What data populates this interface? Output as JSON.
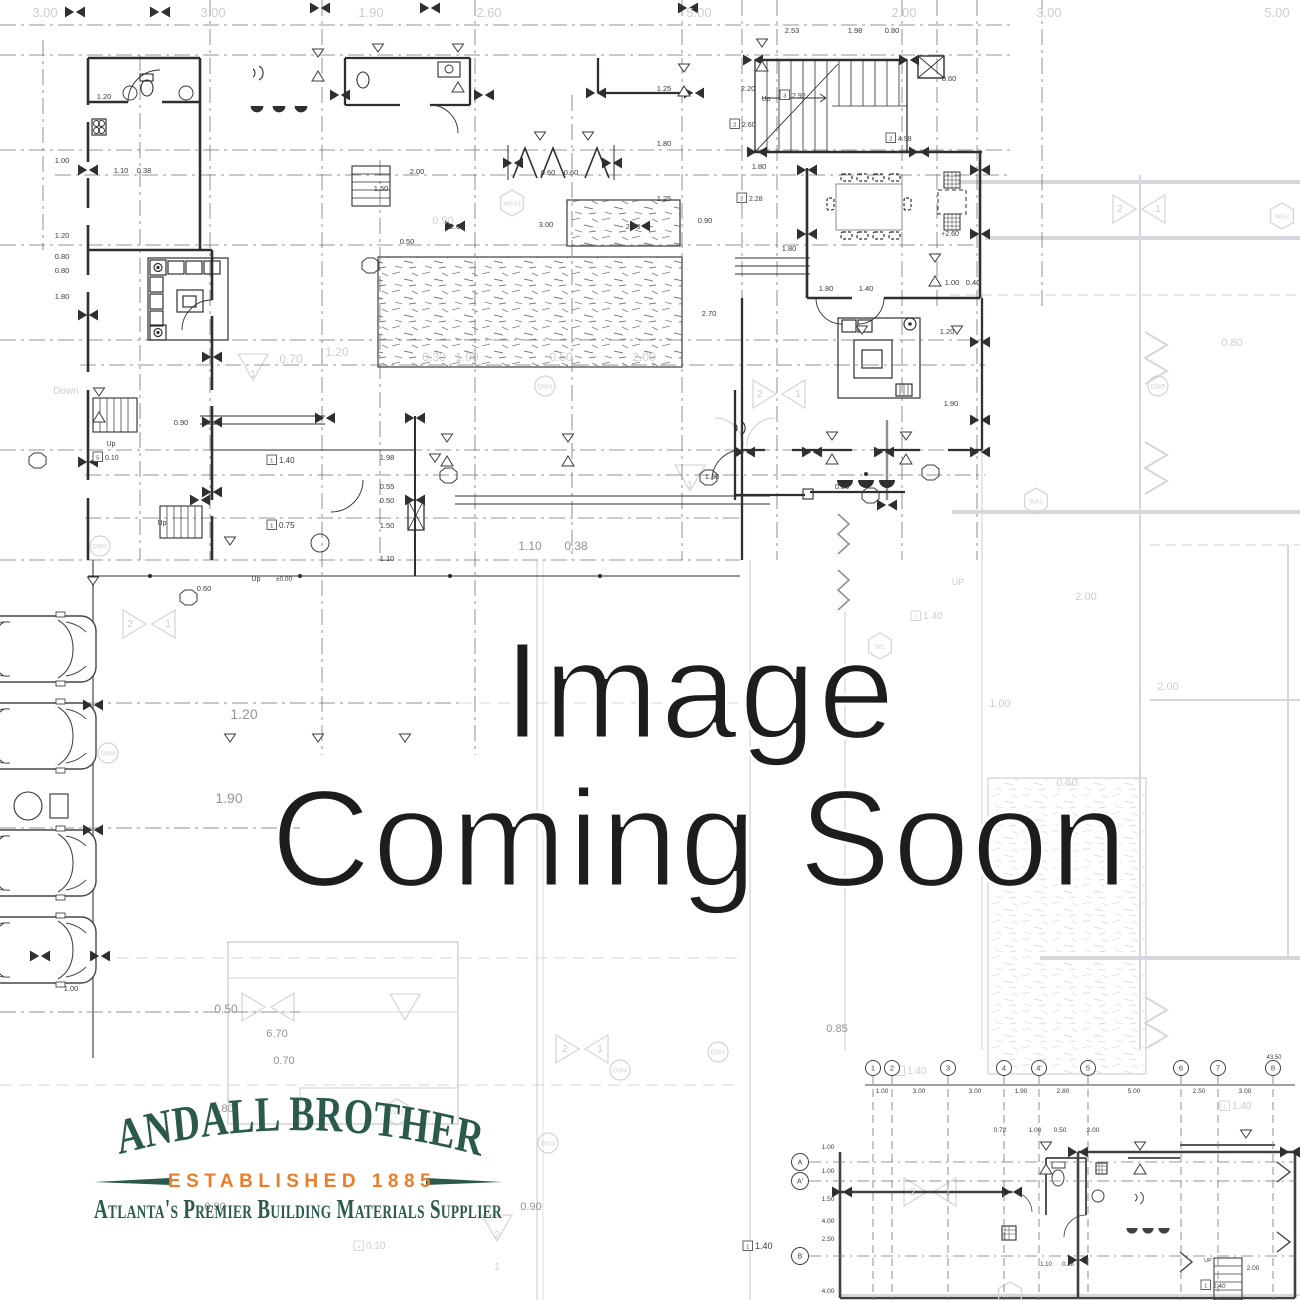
{
  "page": {
    "background": "#ffffff"
  },
  "placeholder": {
    "line1": "Image",
    "line2": "Coming Soon",
    "text_color": "#1d1d1f"
  },
  "logo": {
    "brand": "RANDALL BROTHERS",
    "established": "ESTABLISHED 1885",
    "tagline": "Atlanta's Premier Building Materials Supplier",
    "green": "#2b5a4d",
    "orange": "#ee7b27"
  },
  "blueprint": {
    "dimension_labels": [
      {
        "t": "3.00",
        "x": 45,
        "y": 17,
        "c": "f",
        "s": 13
      },
      {
        "t": "3.00",
        "x": 213,
        "y": 17,
        "c": "f",
        "s": 13
      },
      {
        "t": "1.90",
        "x": 371,
        "y": 17,
        "c": "f",
        "s": 13
      },
      {
        "t": "2.60",
        "x": 489,
        "y": 17,
        "c": "f",
        "s": 13
      },
      {
        "t": "5.00",
        "x": 699,
        "y": 17,
        "c": "f",
        "s": 13
      },
      {
        "t": "2.00",
        "x": 904,
        "y": 17,
        "c": "f",
        "s": 13
      },
      {
        "t": "3.00",
        "x": 1049,
        "y": 17,
        "c": "f",
        "s": 13
      },
      {
        "t": "5.00",
        "x": 1277,
        "y": 17,
        "c": "f",
        "s": 13
      },
      {
        "t": "0.70",
        "x": 291,
        "y": 363,
        "c": "f",
        "s": 12
      },
      {
        "t": "0.30",
        "x": 434,
        "y": 361,
        "c": "f",
        "s": 12
      },
      {
        "t": "1.00",
        "x": 467,
        "y": 361,
        "c": "f",
        "s": 12
      },
      {
        "t": "0.50",
        "x": 561,
        "y": 361,
        "c": "f",
        "s": 12
      },
      {
        "t": "2.00",
        "x": 644,
        "y": 361,
        "c": "f",
        "s": 12
      },
      {
        "t": "1.20",
        "x": 337,
        "y": 356,
        "c": "f",
        "s": 12
      },
      {
        "t": "0.90",
        "x": 443,
        "y": 224,
        "c": "f",
        "s": 11
      },
      {
        "t": "Down",
        "x": 66,
        "y": 394,
        "c": "f",
        "s": 10
      },
      {
        "t": "1.20",
        "x": 244,
        "y": 719,
        "c": "m",
        "s": 14
      },
      {
        "t": "1.90",
        "x": 229,
        "y": 803,
        "c": "m",
        "s": 14
      },
      {
        "t": "1.10",
        "x": 530,
        "y": 550,
        "c": "m",
        "s": 12
      },
      {
        "t": "0.38",
        "x": 576,
        "y": 550,
        "c": "m",
        "s": 12
      },
      {
        "t": "0.50",
        "x": 226,
        "y": 1013,
        "c": "m",
        "s": 12
      },
      {
        "t": "0.70",
        "x": 284,
        "y": 1064,
        "c": "m",
        "s": 11
      },
      {
        "t": "1.80",
        "x": 223,
        "y": 1112,
        "c": "m",
        "s": 11
      },
      {
        "t": "6.70",
        "x": 277,
        "y": 1037,
        "c": "m",
        "s": 11
      },
      {
        "t": "0.90",
        "x": 215,
        "y": 1210,
        "c": "m",
        "s": 11
      },
      {
        "t": "0.90",
        "x": 531,
        "y": 1210,
        "c": "m",
        "s": 11
      },
      {
        "t": "0.85",
        "x": 837,
        "y": 1032,
        "c": "m",
        "s": 11
      },
      {
        "t": "1.00",
        "x": 1000,
        "y": 707,
        "c": "f",
        "s": 11
      },
      {
        "t": "0.50",
        "x": 1067,
        "y": 786,
        "c": "f",
        "s": 11
      },
      {
        "t": "2.00",
        "x": 1086,
        "y": 600,
        "c": "f",
        "s": 11
      },
      {
        "t": "2.00",
        "x": 1168,
        "y": 690,
        "c": "f",
        "s": 11
      },
      {
        "t": "0.80",
        "x": 1232,
        "y": 346,
        "c": "f",
        "s": 11
      },
      {
        "t": "UP",
        "x": 958,
        "y": 585,
        "c": "f",
        "s": 9
      },
      {
        "t": "1.40",
        "x": 928,
        "y": 619,
        "c": "f",
        "s": 10,
        "n": "1"
      },
      {
        "t": "1.40",
        "x": 912,
        "y": 1074,
        "c": "f",
        "s": 10,
        "n": "1"
      },
      {
        "t": "1.40",
        "x": 1237,
        "y": 1109,
        "c": "f",
        "s": 10,
        "n": "1"
      },
      {
        "t": "0.10",
        "x": 371,
        "y": 1249,
        "c": "f",
        "s": 10,
        "n": "4"
      },
      {
        "t": "2",
        "x": 130,
        "y": 627,
        "c": "f",
        "s": 10
      },
      {
        "t": "1",
        "x": 168,
        "y": 627,
        "c": "f",
        "s": 10
      },
      {
        "t": "1",
        "x": 690,
        "y": 488,
        "c": "f",
        "s": 10
      },
      {
        "t": "1",
        "x": 253,
        "y": 377,
        "c": "f",
        "s": 10
      },
      {
        "t": "2",
        "x": 497,
        "y": 1238,
        "c": "f",
        "s": 10
      },
      {
        "t": "1",
        "x": 497,
        "y": 1270,
        "c": "f",
        "s": 10
      },
      {
        "t": "2",
        "x": 1120,
        "y": 212,
        "c": "f",
        "s": 10
      },
      {
        "t": "1",
        "x": 1158,
        "y": 212,
        "c": "f",
        "s": 10
      },
      {
        "t": "2",
        "x": 760,
        "y": 397,
        "c": "f",
        "s": 10
      },
      {
        "t": "1",
        "x": 798,
        "y": 397,
        "c": "f",
        "s": 10
      },
      {
        "t": "2",
        "x": 565,
        "y": 1052,
        "c": "f",
        "s": 10
      },
      {
        "t": "1",
        "x": 600,
        "y": 1052,
        "c": "f",
        "s": 10
      },
      {
        "t": "2",
        "x": 913,
        "y": 1195,
        "c": "f",
        "s": 10
      },
      {
        "t": "1",
        "x": 948,
        "y": 1195,
        "c": "f",
        "s": 10
      },
      {
        "t": "1.20",
        "x": 104,
        "y": 99
      },
      {
        "t": "1.10",
        "x": 121,
        "y": 173
      },
      {
        "t": "0.38",
        "x": 144,
        "y": 173
      },
      {
        "t": "2.00",
        "x": 417,
        "y": 174
      },
      {
        "t": "1.50",
        "x": 381,
        "y": 191
      },
      {
        "t": "0.50",
        "x": 407,
        "y": 244
      },
      {
        "t": "2.03",
        "x": 457,
        "y": 229
      },
      {
        "t": "3.00",
        "x": 546,
        "y": 227
      },
      {
        "t": "2.03",
        "x": 633,
        "y": 229
      },
      {
        "t": "0.60",
        "x": 548,
        "y": 175
      },
      {
        "t": "0.60",
        "x": 571,
        "y": 175
      },
      {
        "t": "1.80",
        "x": 759,
        "y": 169
      },
      {
        "t": "2.20",
        "x": 748,
        "y": 91
      },
      {
        "t": "2.53",
        "x": 792,
        "y": 33
      },
      {
        "t": "1.98",
        "x": 855,
        "y": 33
      },
      {
        "t": "0.80",
        "x": 892,
        "y": 33
      },
      {
        "t": "0.60",
        "x": 949,
        "y": 81
      },
      {
        "t": "1.25",
        "x": 664,
        "y": 91
      },
      {
        "t": "1.80",
        "x": 664,
        "y": 146
      },
      {
        "t": "1.25",
        "x": 664,
        "y": 201
      },
      {
        "t": "0.90",
        "x": 705,
        "y": 223
      },
      {
        "t": "1.80",
        "x": 789,
        "y": 251
      },
      {
        "t": "1.00",
        "x": 952,
        "y": 285
      },
      {
        "t": "0.40",
        "x": 973,
        "y": 285
      },
      {
        "t": "1.80",
        "x": 826,
        "y": 291
      },
      {
        "t": "1.40",
        "x": 866,
        "y": 291
      },
      {
        "t": "0.80",
        "x": 842,
        "y": 489
      },
      {
        "t": "1.30",
        "x": 712,
        "y": 479
      },
      {
        "t": "2.70",
        "x": 709,
        "y": 316
      },
      {
        "t": "1.90",
        "x": 951,
        "y": 406
      },
      {
        "t": "1.20",
        "x": 947,
        "y": 334
      },
      {
        "t": "1.00",
        "x": 62,
        "y": 163
      },
      {
        "t": "1.20",
        "x": 62,
        "y": 238
      },
      {
        "t": "0.80",
        "x": 62,
        "y": 259
      },
      {
        "t": "0.80",
        "x": 62,
        "y": 273
      },
      {
        "t": "1.80",
        "x": 62,
        "y": 299
      },
      {
        "t": "0.90",
        "x": 181,
        "y": 425
      },
      {
        "t": "1.98",
        "x": 387,
        "y": 460
      },
      {
        "t": "0.55",
        "x": 387,
        "y": 489
      },
      {
        "t": "0.50",
        "x": 387,
        "y": 503
      },
      {
        "t": "1.50",
        "x": 387,
        "y": 528
      },
      {
        "t": "1.10",
        "x": 387,
        "y": 561
      },
      {
        "t": "0.60",
        "x": 204,
        "y": 591
      },
      {
        "t": "1.00",
        "x": 71,
        "y": 991
      },
      {
        "t": "+2.60",
        "x": 950,
        "y": 236,
        "s": 7
      },
      {
        "t": "±0.00",
        "x": 284,
        "y": 581,
        "s": 6.5
      },
      {
        "t": "Up",
        "x": 111,
        "y": 446,
        "s": 7
      },
      {
        "t": "Up",
        "x": 162,
        "y": 525,
        "s": 7
      },
      {
        "t": "Up",
        "x": 256,
        "y": 581,
        "s": 7
      },
      {
        "t": "Up",
        "x": 766,
        "y": 101,
        "s": 7
      },
      {
        "t": "0.10",
        "x": 110,
        "y": 460,
        "s": 7,
        "n": "5"
      },
      {
        "t": "1.40",
        "x": 284,
        "y": 463,
        "s": 8,
        "n": "1"
      },
      {
        "t": "0.75",
        "x": 284,
        "y": 528,
        "s": 8,
        "n": "1"
      },
      {
        "t": "2.92",
        "x": 797,
        "y": 98,
        "s": 7,
        "n": "3"
      },
      {
        "t": "2.60",
        "x": 747,
        "y": 127,
        "s": 7,
        "n": "2"
      },
      {
        "t": "4.98",
        "x": 903,
        "y": 141,
        "s": 7,
        "n": "2"
      },
      {
        "t": "2.28",
        "x": 754,
        "y": 201,
        "s": 7,
        "n": "2"
      },
      {
        "t": "1.40",
        "x": 760,
        "y": 1249,
        "s": 9,
        "n": "1"
      },
      {
        "t": "1.00",
        "x": 882,
        "y": 1093,
        "s": 6.5
      },
      {
        "t": "3.00",
        "x": 919,
        "y": 1093,
        "s": 6.5
      },
      {
        "t": "3.00",
        "x": 975,
        "y": 1093,
        "s": 6.5
      },
      {
        "t": "1.90",
        "x": 1021,
        "y": 1093,
        "s": 6.5
      },
      {
        "t": "2.80",
        "x": 1063,
        "y": 1093,
        "s": 6.5
      },
      {
        "t": "5.00",
        "x": 1134,
        "y": 1093,
        "s": 6.5
      },
      {
        "t": "2.50",
        "x": 1199,
        "y": 1093,
        "s": 6.5
      },
      {
        "t": "3.00",
        "x": 1245,
        "y": 1093,
        "s": 6.5
      },
      {
        "t": "43.50",
        "x": 1274,
        "y": 1059,
        "s": 6
      },
      {
        "t": "1.00",
        "x": 828,
        "y": 1149,
        "s": 6.5
      },
      {
        "t": "1.00",
        "x": 828,
        "y": 1173,
        "s": 6.5
      },
      {
        "t": "1.50",
        "x": 828,
        "y": 1201,
        "s": 6.5
      },
      {
        "t": "4.00",
        "x": 828,
        "y": 1223,
        "s": 6.5
      },
      {
        "t": "2.50",
        "x": 828,
        "y": 1241,
        "s": 6.5
      },
      {
        "t": "4.00",
        "x": 828,
        "y": 1293,
        "s": 6.5
      },
      {
        "t": "0.72",
        "x": 1000,
        "y": 1132,
        "s": 6.5
      },
      {
        "t": "1.00",
        "x": 1035,
        "y": 1132,
        "s": 6.5
      },
      {
        "t": "0.50",
        "x": 1060,
        "y": 1132,
        "s": 6.5
      },
      {
        "t": "2.00",
        "x": 1093,
        "y": 1132,
        "s": 6.5
      },
      {
        "t": "2.00",
        "x": 1253,
        "y": 1270,
        "s": 6.5
      },
      {
        "t": "2.40",
        "x": 1218,
        "y": 1288,
        "s": 6.5,
        "n": "1"
      },
      {
        "t": "UP",
        "x": 1208,
        "y": 1262,
        "s": 5.5
      },
      {
        "t": "1.10",
        "x": 1046,
        "y": 1266,
        "s": 6
      },
      {
        "t": "0.38",
        "x": 1068,
        "y": 1266,
        "s": 6
      }
    ],
    "grid_columns": {
      "y": 1068,
      "items": [
        "1",
        "2",
        "3",
        "4",
        "4'",
        "5",
        "6",
        "7",
        "8"
      ],
      "x": [
        873,
        892,
        948,
        1004,
        1039,
        1088,
        1181,
        1218,
        1273
      ]
    },
    "grid_rows": {
      "x": 800,
      "items": [
        "A",
        "A'",
        "B"
      ],
      "y": [
        1162,
        1181,
        1256
      ]
    },
    "zone_tags": [
      {
        "t": "WA13",
        "x": 512,
        "y": 203,
        "k": "hex"
      },
      {
        "t": "WA2",
        "x": 1282,
        "y": 216,
        "k": "hex"
      },
      {
        "t": "WA2",
        "x": 1036,
        "y": 501,
        "k": "hex"
      },
      {
        "t": "W1",
        "x": 880,
        "y": 646,
        "k": "hex"
      },
      {
        "t": "WA1",
        "x": 397,
        "y": 1112,
        "k": "hex"
      },
      {
        "t": "WA4",
        "x": 1010,
        "y": 1295,
        "k": "hex"
      },
      {
        "t": "DW8",
        "x": 1158,
        "y": 386,
        "k": "circ"
      },
      {
        "t": "DW3",
        "x": 100,
        "y": 546,
        "k": "circ"
      },
      {
        "t": "DW3",
        "x": 548,
        "y": 1143,
        "k": "circ"
      },
      {
        "t": "DW1",
        "x": 718,
        "y": 1052,
        "k": "circ"
      },
      {
        "t": "DW4",
        "x": 620,
        "y": 1070,
        "k": "circ"
      },
      {
        "t": "DW4",
        "x": 545,
        "y": 386,
        "k": "circ"
      },
      {
        "t": "DW4",
        "x": 108,
        "y": 753,
        "k": "circ"
      }
    ]
  }
}
